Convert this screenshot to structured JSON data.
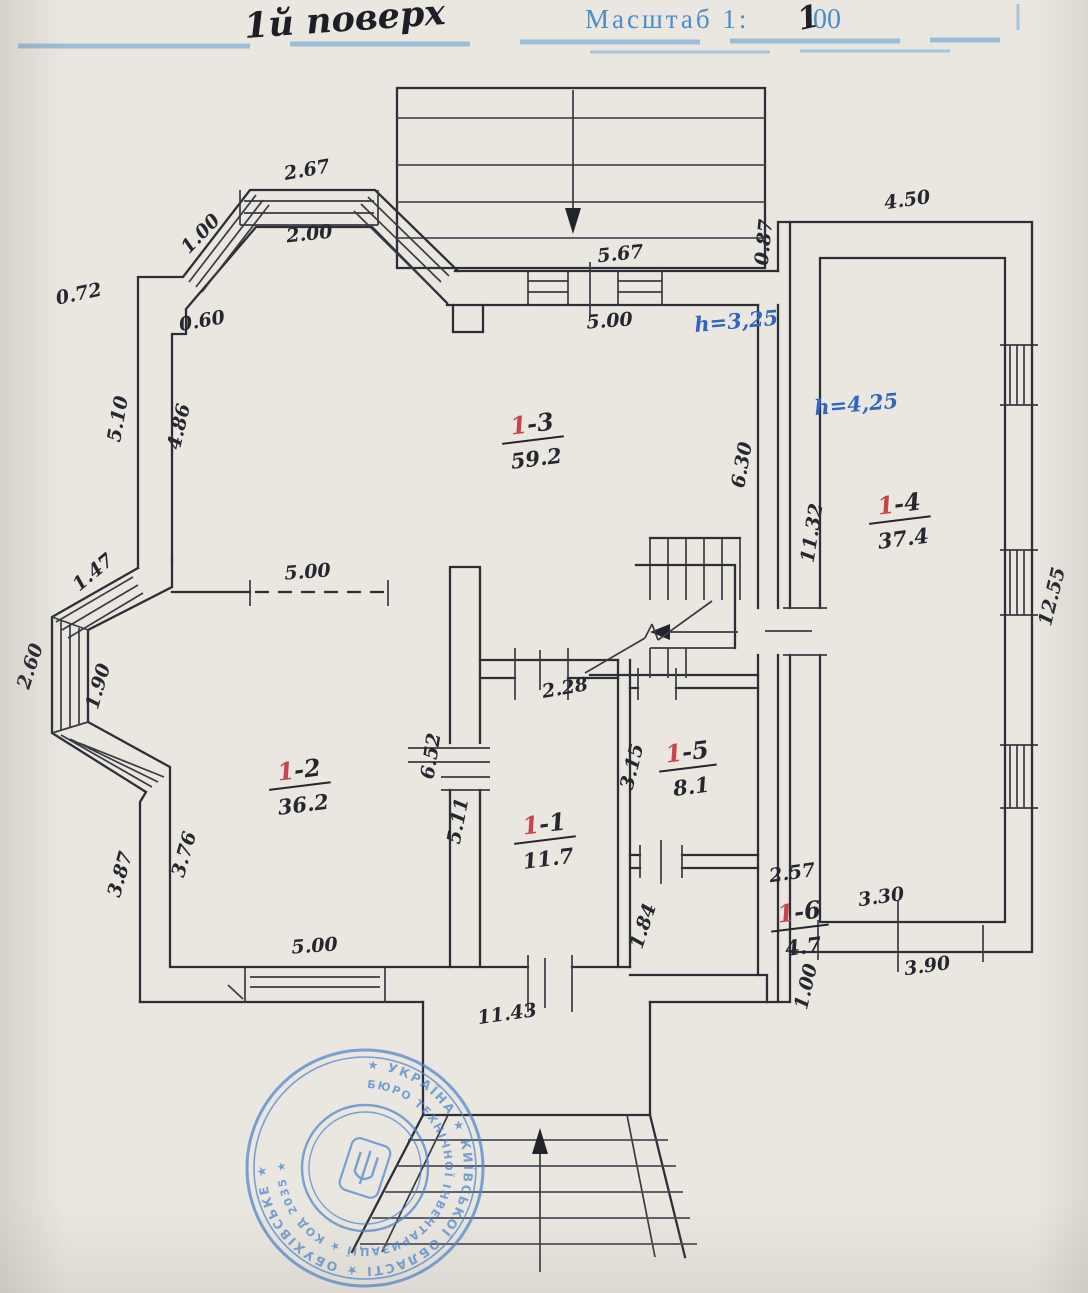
{
  "header": {
    "floor_label": "1й поверх",
    "scale_label": "Масштаб 1:",
    "scale_value_written": "1",
    "scale_value_printed": "00"
  },
  "plan": {
    "heights": [
      {
        "text": "h=3,25"
      },
      {
        "text": "h=4,25"
      }
    ],
    "rooms": [
      {
        "num_red": "1",
        "num_rest": "-3",
        "area": "59.2"
      },
      {
        "num_red": "1",
        "num_rest": "-2",
        "area": "36.2"
      },
      {
        "num_red": "1",
        "num_rest": "-1",
        "area": "11.7"
      },
      {
        "num_red": "1",
        "num_rest": "-5",
        "area": "8.1"
      },
      {
        "num_red": "1",
        "num_rest": "-6",
        "area": "4.7"
      },
      {
        "num_red": "1",
        "num_rest": "-4",
        "area": "37.4"
      }
    ],
    "dimensions": [
      {
        "text": "2.67",
        "x": 308,
        "y": 176,
        "r": -10
      },
      {
        "text": "1.00",
        "x": 205,
        "y": 238,
        "r": -46
      },
      {
        "text": "2.00",
        "x": 310,
        "y": 240,
        "r": -6
      },
      {
        "text": "0.72",
        "x": 80,
        "y": 300,
        "r": -12
      },
      {
        "text": "0.60",
        "x": 203,
        "y": 327,
        "r": -10
      },
      {
        "text": "5.10",
        "x": 124,
        "y": 420,
        "r": -80
      },
      {
        "text": "4.86",
        "x": 185,
        "y": 428,
        "r": -77
      },
      {
        "text": "5.67",
        "x": 621,
        "y": 260,
        "r": -6
      },
      {
        "text": "5.00",
        "x": 610,
        "y": 327,
        "r": -4
      },
      {
        "text": "0.87",
        "x": 770,
        "y": 243,
        "r": -84
      },
      {
        "text": "4.50",
        "x": 908,
        "y": 206,
        "r": -8
      },
      {
        "text": "6.30",
        "x": 748,
        "y": 466,
        "r": -80
      },
      {
        "text": "11.32",
        "x": 818,
        "y": 534,
        "r": -81
      },
      {
        "text": "12.55",
        "x": 1058,
        "y": 598,
        "r": -76
      },
      {
        "text": "1.47",
        "x": 97,
        "y": 577,
        "r": -40
      },
      {
        "text": "2.60",
        "x": 36,
        "y": 668,
        "r": -72
      },
      {
        "text": "1.90",
        "x": 104,
        "y": 688,
        "r": -74
      },
      {
        "text": "5.00",
        "x": 308,
        "y": 578,
        "r": -4
      },
      {
        "text": "2.28",
        "x": 566,
        "y": 694,
        "r": -10
      },
      {
        "text": "6.52",
        "x": 437,
        "y": 757,
        "r": -81
      },
      {
        "text": "5.11",
        "x": 464,
        "y": 822,
        "r": -79
      },
      {
        "text": "3.15",
        "x": 638,
        "y": 768,
        "r": -76
      },
      {
        "text": "3.76",
        "x": 190,
        "y": 856,
        "r": -74
      },
      {
        "text": "3.87",
        "x": 126,
        "y": 876,
        "r": -74
      },
      {
        "text": "5.00",
        "x": 315,
        "y": 952,
        "r": -4
      },
      {
        "text": "1.84",
        "x": 649,
        "y": 928,
        "r": -72
      },
      {
        "text": "2.57",
        "x": 793,
        "y": 879,
        "r": -8
      },
      {
        "text": "3.30",
        "x": 882,
        "y": 903,
        "r": -8
      },
      {
        "text": "3.90",
        "x": 928,
        "y": 972,
        "r": -8
      },
      {
        "text": "1.00",
        "x": 812,
        "y": 988,
        "r": -77
      },
      {
        "text": "11.43",
        "x": 508,
        "y": 1020,
        "r": -8
      }
    ]
  },
  "stamp": {
    "outer_ring_text": "★ УКРАЇНА ★ КИЇВСЬКОЇ ОБЛАСТІ ★ ОБУХІВСЬКЕ ★",
    "inner_ring_text": "БЮРО ТЕХНІЧНОЇ ІНВЕНТАРИЗАЦІЇ ★ КОД 2035 ★"
  }
}
